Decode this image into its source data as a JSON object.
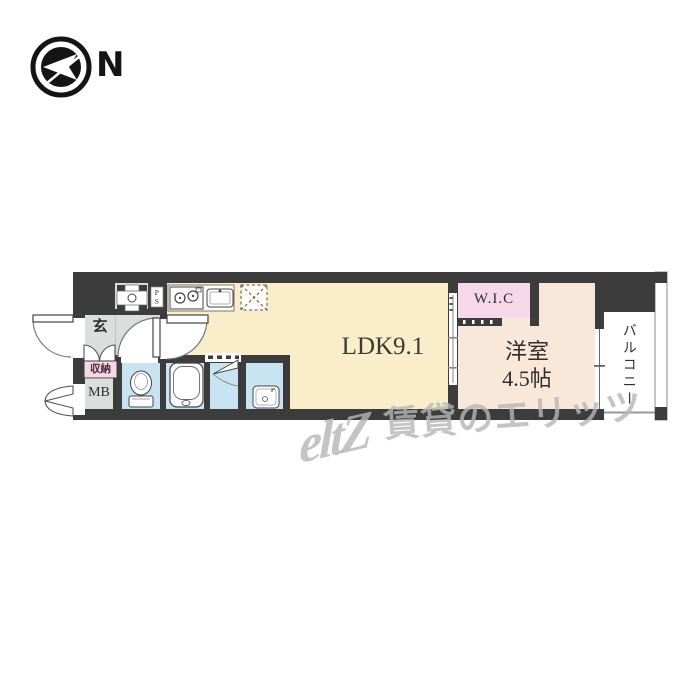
{
  "compass": {
    "north_label": "N"
  },
  "plan": {
    "entrance_label": "玄",
    "storage_label": "収納",
    "meter_box_label": "MB",
    "pipe_space_label": "PS",
    "ldk_label": "LDK9.1",
    "wic_label": "W.I.C",
    "bedroom_label_line1": "洋室",
    "bedroom_label_line2": "4.5帖",
    "balcony_label": "バルコニー"
  },
  "watermark": {
    "logo_text": "eltZ",
    "brand_text": "賃貸のエリッツ"
  },
  "colors": {
    "wall": "#3c3c3c",
    "ldk": "#faeeca",
    "bedroom": "#f9e8d9",
    "wic": "#f7d8e8",
    "wet_area": "#c8e4f2",
    "hall": "#dcdddd",
    "storage_tag": "#f6d7e7",
    "balcony": "#ffffff",
    "watermark": "#b5b5b5"
  },
  "icons": [
    "north-arrow-icon",
    "washing-machine-icon",
    "stove-icon",
    "sink-icon",
    "refrigerator-icon",
    "bathtub-icon",
    "toilet-icon",
    "washbasin-icon"
  ]
}
